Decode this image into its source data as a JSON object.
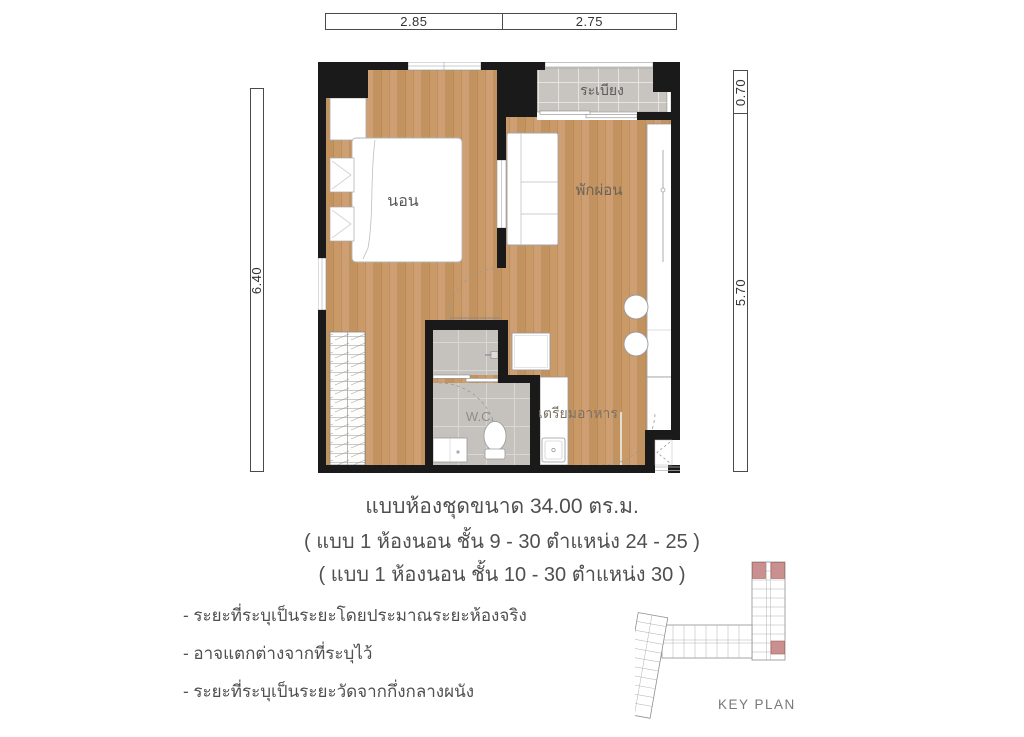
{
  "plan": {
    "rooms": {
      "balcony": "ระเบียง",
      "bedroom": "นอน",
      "living": "พักผ่อน",
      "wc": "W.C.",
      "kitchen": "เตรียมอาหาร"
    },
    "dimensions": {
      "top_left": "2.85",
      "top_right": "2.75",
      "left": "6.40",
      "right_top": "0.70",
      "right_bottom": "5.70"
    }
  },
  "caption": {
    "title": "แบบห้องชุดขนาด 34.00 ตร.ม.",
    "subtitle1": "( แบบ 1 ห้องนอน ชั้น 9 - 30 ตำแหน่ง 24 - 25 )",
    "subtitle2": "( แบบ 1 ห้องนอน ชั้น 10 - 30 ตำแหน่ง 30 )"
  },
  "notes": [
    "- ระยะที่ระบุเป็นระยะโดยประมาณระยะห้องจริง",
    "- อาจแตกต่างจากที่ระบุไว้",
    "- ระยะที่ระบุเป็นระยะวัดจากกึ่งกลางผนัง"
  ],
  "key_plan": {
    "label": "KEY PLAN"
  },
  "colors": {
    "wood": "#c79a6b",
    "balcony_tile": "#c8c5c0",
    "bath_tile": "#c6c3be",
    "wall": "#1a1a1a",
    "highlight": "#ca8f8f",
    "text": "#4f4f4f"
  }
}
